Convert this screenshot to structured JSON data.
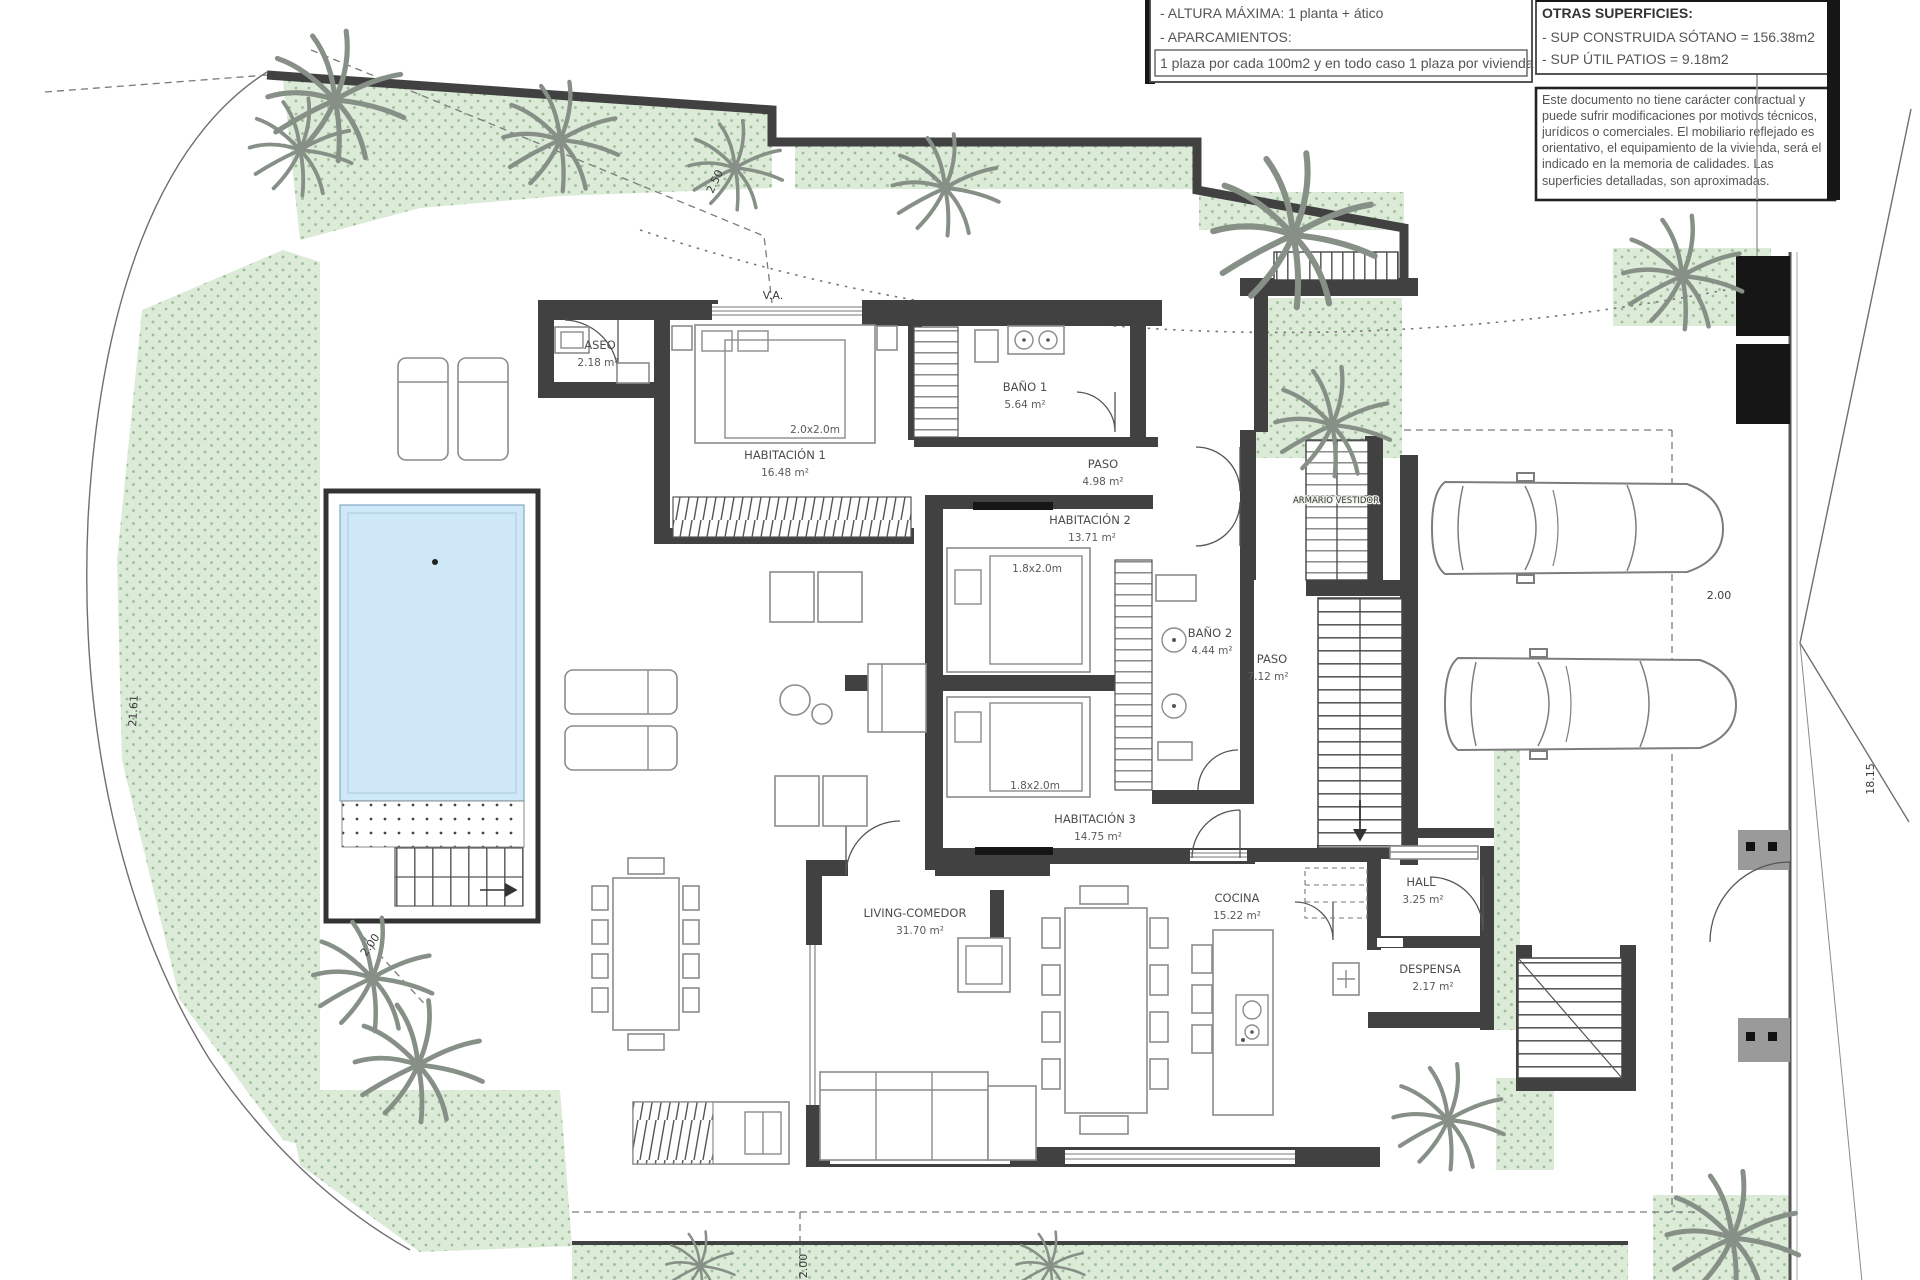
{
  "title_block": {
    "building_params": {
      "line1": "- ALTURA MÁXIMA: 1 planta + ático",
      "line2": "- APARCAMIENTOS:",
      "boxed_line": "1 plaza por cada 100m2 y en todo caso 1 plaza por vivienda"
    },
    "other_surfaces": {
      "title": "OTRAS SUPERFICIES:",
      "line1": "- SUP CONSTRUIDA SÓTANO =  156.38m2",
      "line2": "- SUP ÚTIL PATIOS =  9.18m2"
    },
    "disclaimer": "Este documento no tiene carácter contractual y puede sufrir modificaciones por motivos técnicos, jurídicos o comerciales. El mobiliario reflejado es orientativo, el equipamiento de la vivienda, será el indicado en la memoria de calidades. Las superficies detalladas, son aproximadas."
  },
  "rooms": {
    "aseo": {
      "name": "ASEO",
      "area": "2.18 m²"
    },
    "habitacion1": {
      "name": "HABITACIÓN 1",
      "area": "16.48 m²"
    },
    "bano1": {
      "name": "BAÑO 1",
      "area": "5.64 m²"
    },
    "paso1": {
      "name": "PASO",
      "area": "4.98 m²"
    },
    "habitacion2": {
      "name": "HABITACIÓN 2",
      "area": "13.71 m²"
    },
    "bano2": {
      "name": "BAÑO 2",
      "area": "4.44 m²"
    },
    "paso2": {
      "name": "PASO",
      "area": "7.12 m²"
    },
    "armario": {
      "name": "ARMARIO VESTIDOR"
    },
    "habitacion3": {
      "name": "HABITACIÓN 3",
      "area": "14.75 m²"
    },
    "living": {
      "name": "LIVING-COMEDOR",
      "area": "31.70 m²"
    },
    "cocina": {
      "name": "COCINA",
      "area": "15.22 m²"
    },
    "hall": {
      "name": "HALL",
      "area": "3.25 m²"
    },
    "despensa": {
      "name": "DESPENSA",
      "area": "2.17 m²"
    }
  },
  "beds": {
    "bed1": "2.0x2.0m",
    "bed2": "1.8x2.0m",
    "bed3": "1.8x2.0m"
  },
  "dimensions": {
    "left_boundary": "21.61",
    "right_boundary": "18.15",
    "driveway_offset": "2.00",
    "pool_offset": "2.00",
    "bottom_offset": "2.00",
    "top_diagonal": "2.50"
  },
  "annotations": {
    "ventilation": "V.A."
  },
  "colors": {
    "wall": "#414141",
    "garden_fill": "#dcead8",
    "garden_dot": "#9dbd98",
    "pool_water": "#cfe8f7",
    "drawing_line": "#6f6f6f",
    "palm": "#879086"
  }
}
